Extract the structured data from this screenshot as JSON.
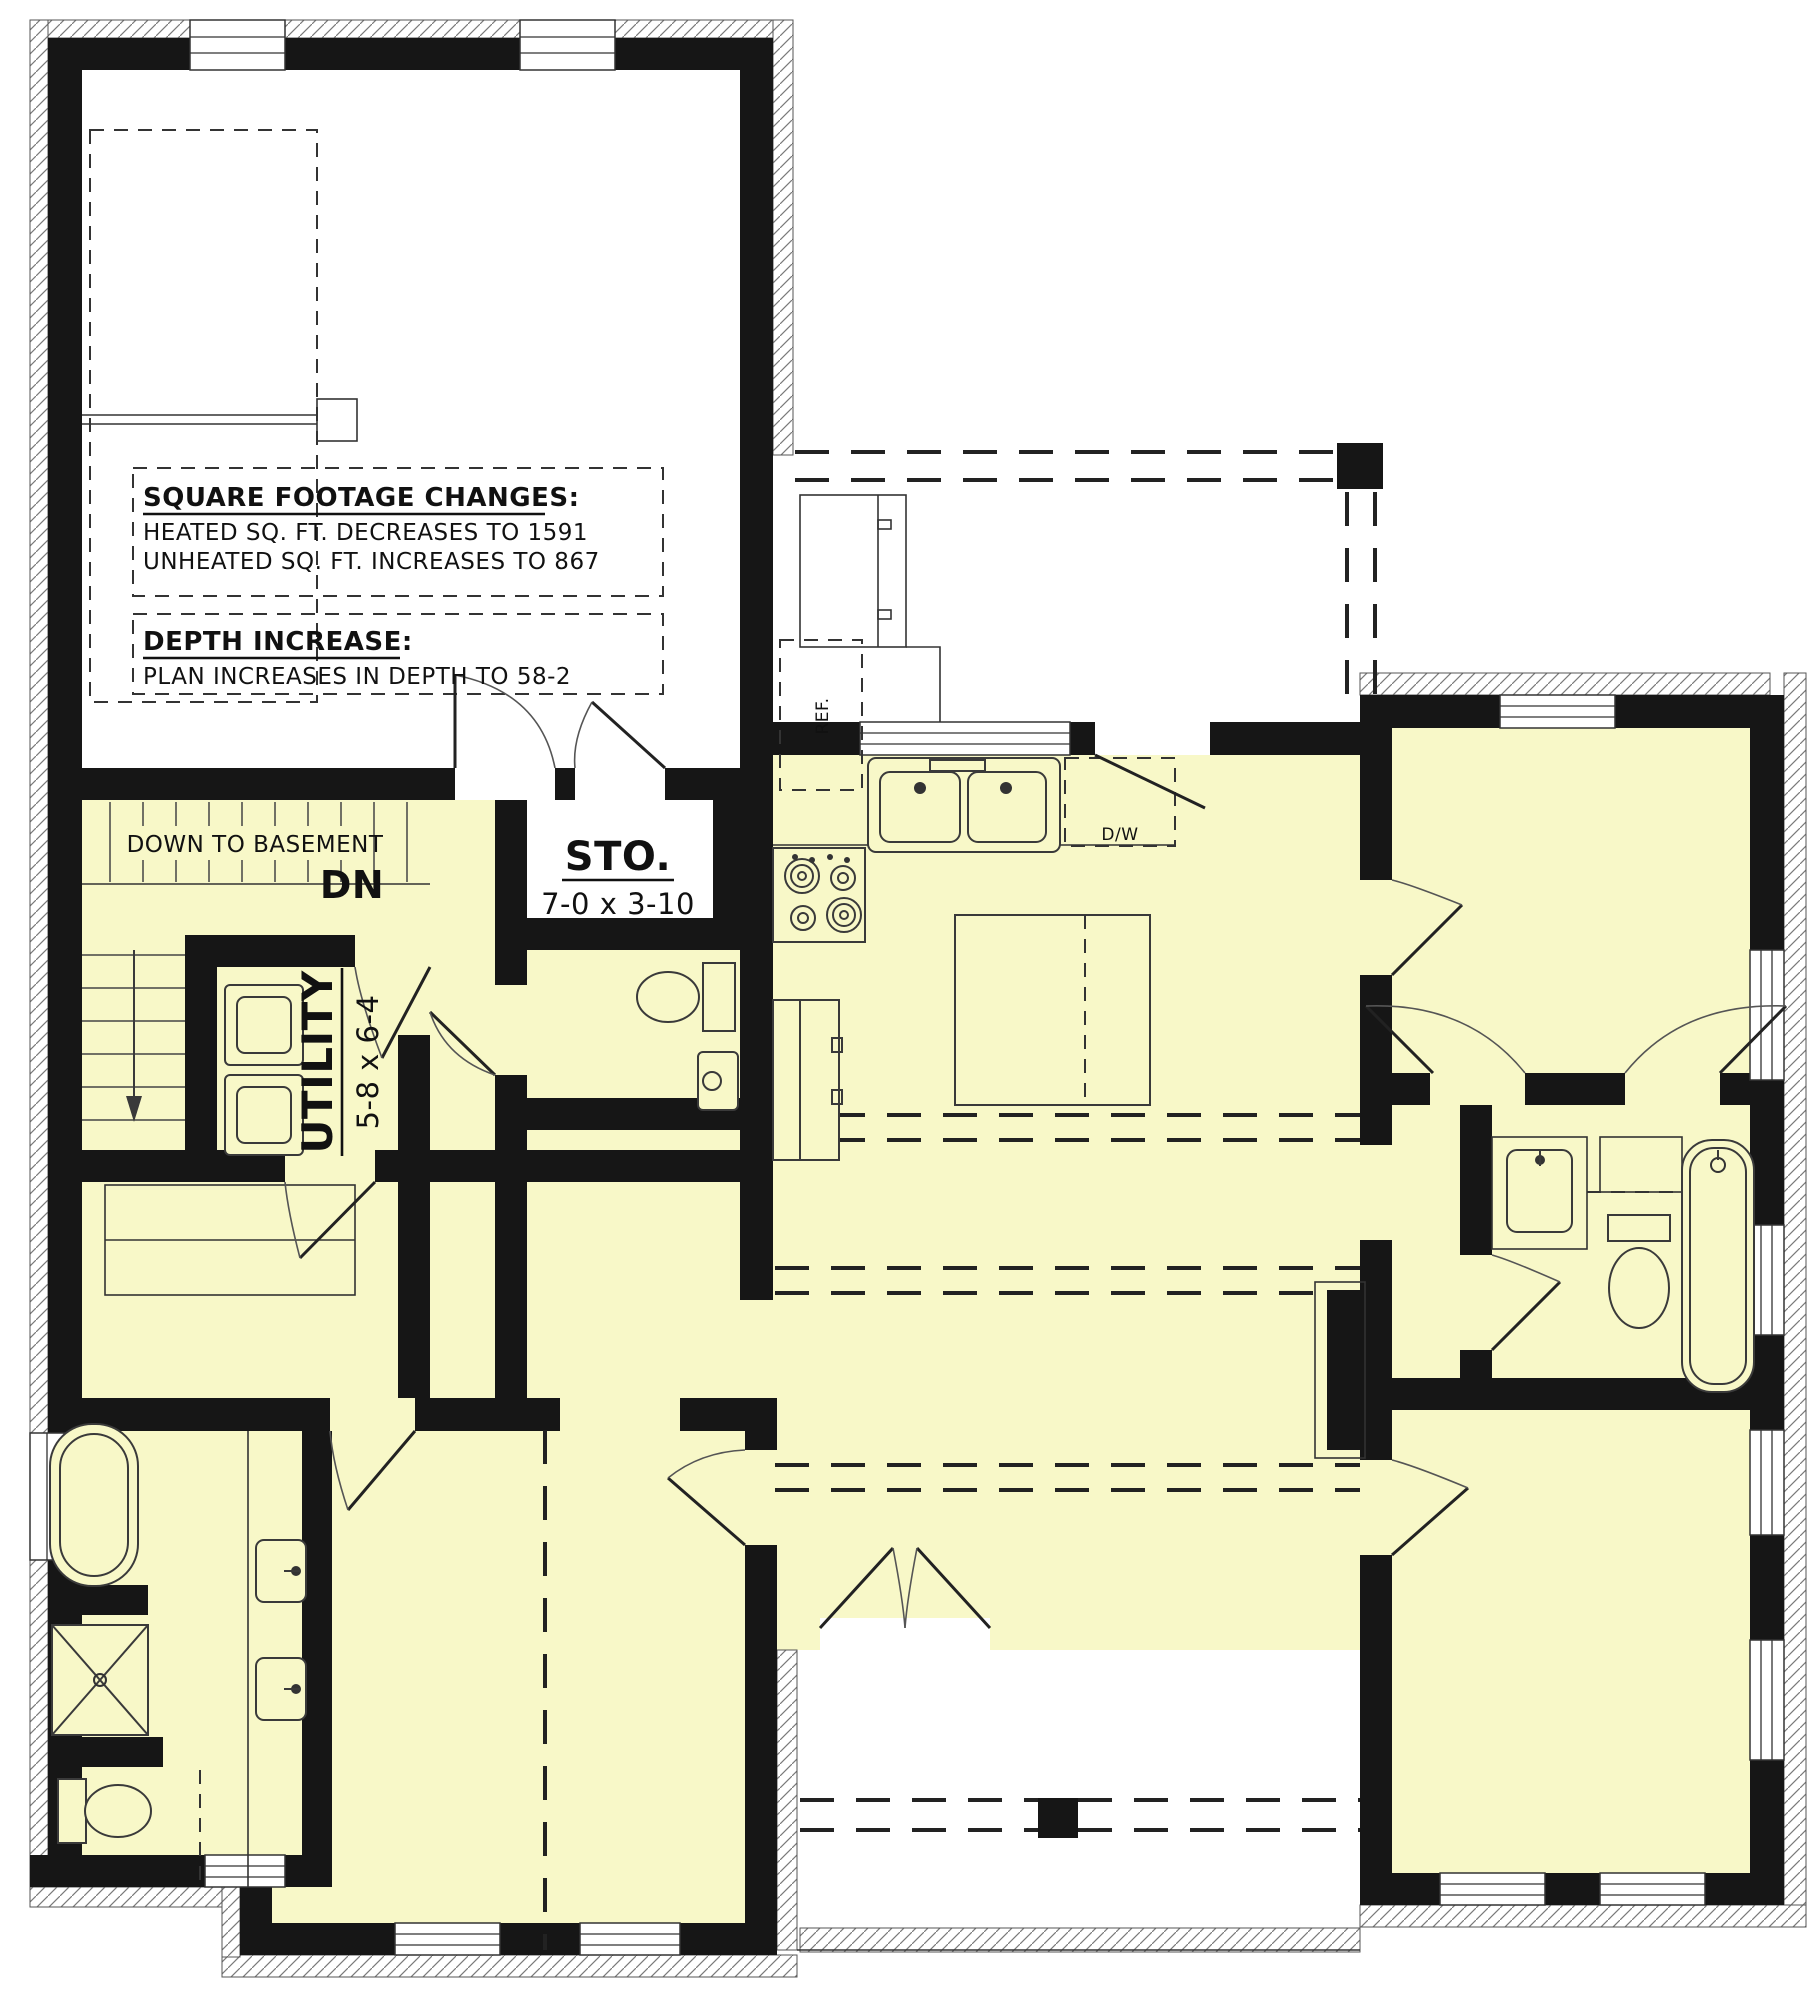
{
  "plan": {
    "title": "first-floor-plan-modification",
    "notes": {
      "sqft_title": "SQUARE FOOTAGE CHANGES:",
      "sqft_line1": "HEATED SQ. FT. DECREASES TO 1591",
      "sqft_line2": "UNHEATED SQ. FT. INCREASES TO 867",
      "depth_title": "DEPTH INCREASE:",
      "depth_line1": "PLAN INCREASES IN DEPTH TO 58-2"
    },
    "rooms": {
      "stairs_label": "DOWN TO BASEMENT",
      "stairs_dn": "DN",
      "storage_name": "STO.",
      "storage_dims": "7-0 x 3-10",
      "utility_name": "UTILITY",
      "utility_dims": "5-8 x 6-4"
    },
    "appliances": {
      "ref": "REF.",
      "dw": "D/W"
    },
    "colors": {
      "room_fill": "#f8f8c8",
      "wall": "#161616",
      "background": "#ffffff"
    }
  }
}
